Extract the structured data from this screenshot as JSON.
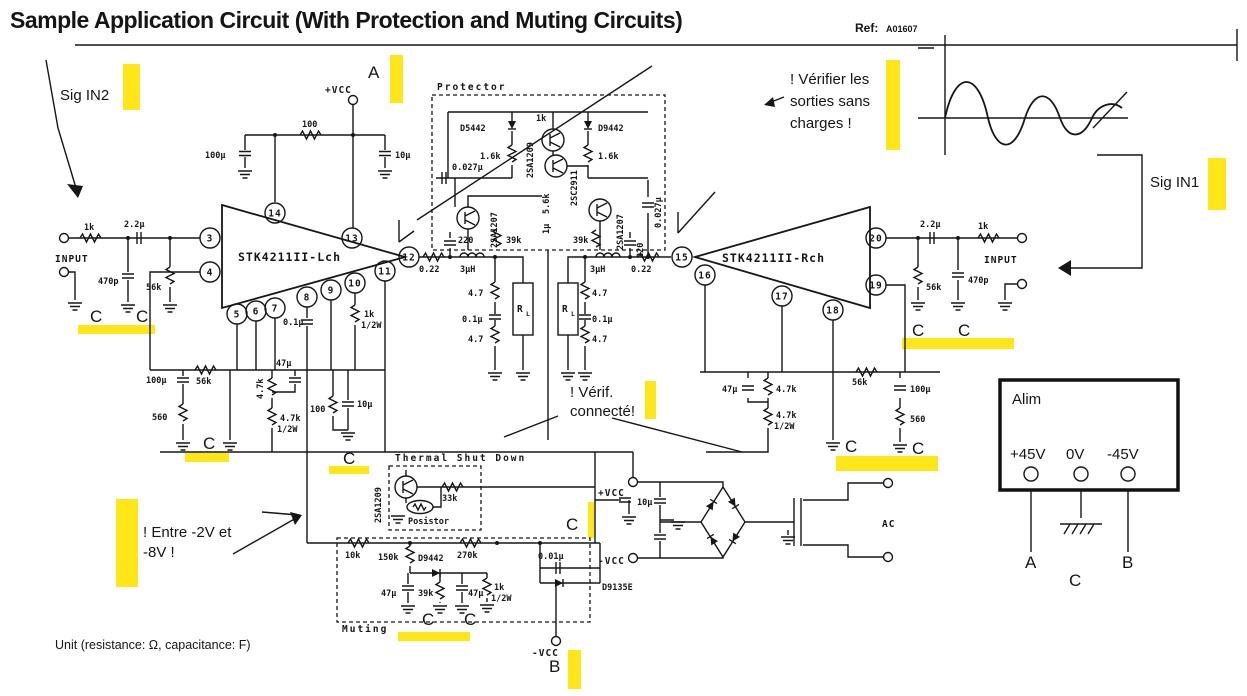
{
  "header": {
    "title": "Sample Application Circuit (With Protection and Muting Circuits)",
    "ref_label": "Ref:",
    "ref_value": "A01607"
  },
  "annotations": {
    "sig_in2": "Sig IN2",
    "sig_in1": "Sig IN1",
    "verify_line1": "! Vérifier les",
    "verify_line2": "sorties sans",
    "verify_line3": "charges !",
    "verif_line1": "! Vérif.",
    "verif_line2": "connecté!",
    "entre_line1": "! Entre -2V et",
    "entre_line2": "-8V !",
    "unit_note": "Unit (resistance: Ω, capacitance: F)"
  },
  "markers": {
    "a": "A",
    "b": "B",
    "c": "C"
  },
  "blocks": {
    "protector": "Protector",
    "thermal": "Thermal Shut Down",
    "muting": "Muting"
  },
  "amplifiers": {
    "left": "STK4211II-Lch",
    "right": "STK4211II-Rch"
  },
  "pins": {
    "3": "3",
    "4": "4",
    "5": "5",
    "6": "6",
    "7": "7",
    "8": "8",
    "9": "9",
    "10": "10",
    "11": "11",
    "12": "12",
    "13": "13",
    "14": "14",
    "15": "15",
    "16": "16",
    "17": "17",
    "18": "18",
    "19": "19",
    "20": "20"
  },
  "labels": {
    "input": "INPUT",
    "vcc_plus": "+VCC",
    "vcc_minus": "-VCC",
    "ac": "AC"
  },
  "alim": {
    "title": "Alim",
    "v_plus": "+45V",
    "v_zero": "0V",
    "v_minus": "-45V"
  },
  "values": {
    "r1k": "1k",
    "r10k": "10k",
    "r33k": "33k",
    "r39k": "39k",
    "r56k": "56k",
    "r5k6": "5.6k",
    "r100": "100",
    "r150k": "150k",
    "r220": "220",
    "r270k": "270k",
    "r560": "560",
    "r4k7": "4.7k",
    "r47": "4.7",
    "r022": "0.22",
    "half": "1/2W",
    "c22u": "2.2µ",
    "c470p": "470p",
    "c100u": "100µ",
    "c10u": "10µ",
    "c47u": "47µ",
    "c1u": "1µ",
    "c01u": "0.1µ",
    "c0027u": "0.027µ",
    "c001u": "0.01µ",
    "l3uh": "3µH",
    "d5442": "D5442",
    "d9442": "D9442",
    "d9135e": "D9135E",
    "q1209": "2SA1209",
    "q1207": "2SA1207",
    "q2911": "2SC2911",
    "posistor": "Posistor",
    "rl": "R",
    "rl_sub": "L",
    "plus": "+"
  },
  "accent_colors": {
    "highlighter": "#ffe619",
    "ink": "#161616"
  }
}
